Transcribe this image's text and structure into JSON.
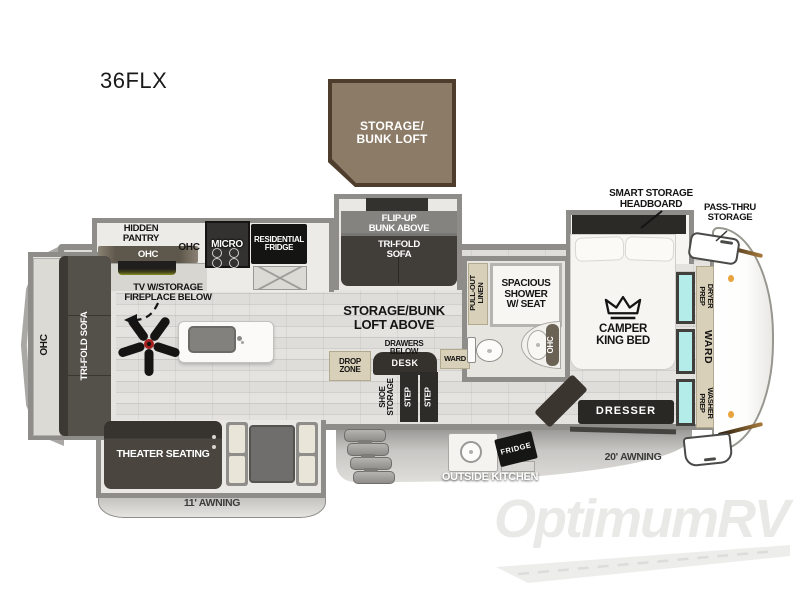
{
  "title": "36FLX",
  "watermark": "OptimumRV",
  "colors": {
    "wall_gray": "#8e8d8a",
    "floor_wood": "#dcdbd8",
    "furniture_dark": "#45413c",
    "appliance_black": "#1a1918",
    "cabinet_tan": "#d9d0ba",
    "window_teal": "#b3ece8",
    "loft_box_brown": "#8c7b67",
    "loft_box_border": "#4e3d2c",
    "awning_gray": "#c9c8c5",
    "marker_orange": "#e8a33d",
    "fan_hub_red": "#a81f1f"
  },
  "loft_box": {
    "label": "STORAGE/\nBUNK LOFT"
  },
  "kitchen": {
    "hidden_pantry": "HIDDEN\nPANTRY",
    "pantry_ohc": "OHC",
    "ohc": "OHC",
    "micro": "MICRO",
    "residential_fridge": "RESIDENTIAL\nFRIDGE",
    "tv": "TV W/STORAGE\nFIREPLACE BELOW"
  },
  "living": {
    "ohc": "OHC",
    "tri_fold_sofa": "TRI-FOLD SOFA",
    "theater_seating": "THEATER SEATING"
  },
  "bunk_room": {
    "flip_up_bunk": "FLIP-UP\nBUNK ABOVE",
    "tri_fold_sofa": "TRI-FOLD\nSOFA",
    "storage_bunk_loft_above": "STORAGE/BUNK\nLOFT ABOVE",
    "drawers_below": "DRAWERS\nBELOW",
    "desk": "DESK",
    "drop_zone": "DROP\nZONE",
    "ward": "WARD",
    "shoe_storage": "SHOE\nSTORAGE",
    "step1": "STEP",
    "step2": "STEP"
  },
  "bathroom": {
    "pull_out_linen": "PULL-OUT\nLINEN",
    "shower": "SPACIOUS\nSHOWER\nW/ SEAT",
    "ohc": "OHC"
  },
  "bedroom": {
    "smart_storage_headboard": "SMART STORAGE\nHEADBOARD",
    "camper_king_bed": "CAMPER\nKING BED",
    "dresser": "DRESSER"
  },
  "right_side": {
    "pass_thru_storage": "PASS-THRU\nSTORAGE",
    "dryer_prep": "DRYER\nPREP",
    "ward": "WARD",
    "washer_prep": "WASHER\nPREP"
  },
  "exterior": {
    "awning_11": "11' AWNING",
    "awning_20": "20' AWNING",
    "outside_kitchen": "OUTSIDE KITCHEN",
    "fridge": "FRIDGE"
  }
}
